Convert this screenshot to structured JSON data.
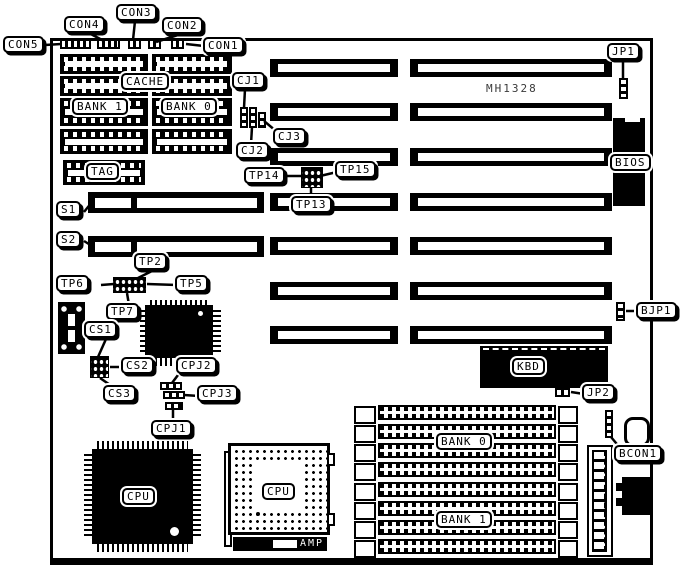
{
  "diagram": {
    "board_model": "MH1328",
    "callouts": {
      "con1": "CON1",
      "con2": "CON2",
      "con3": "CON3",
      "con4": "CON4",
      "con5": "CON5",
      "jp1": "JP1",
      "jp2": "JP2",
      "bjp1": "BJP1",
      "bcon1": "BCON1",
      "cj1": "CJ1",
      "cj2": "CJ2",
      "cj3": "CJ3",
      "tp2": "TP2",
      "tp5": "TP5",
      "tp6": "TP6",
      "tp7": "TP7",
      "tp13": "TP13",
      "tp14": "TP14",
      "tp15": "TP15",
      "s1": "S1",
      "s2": "S2",
      "cs1": "CS1",
      "cs2": "CS2",
      "cs3": "CS3",
      "cpj1": "CPJ1",
      "cpj2": "CPJ2",
      "cpj3": "CPJ3"
    },
    "components": {
      "cache": "CACHE",
      "cache_bank_1": "BANK 1",
      "cache_bank_0": "BANK 0",
      "tag": "TAG",
      "bios": "BIOS",
      "kbd": "KBD",
      "simm_bank_0": "BANK 0",
      "simm_bank_1": "BANK 1",
      "cpu_qfp": "CPU",
      "cpu_pga": "CPU",
      "amp": "AMP"
    },
    "colors": {
      "ink": "#000000",
      "paper": "#ffffff"
    }
  }
}
